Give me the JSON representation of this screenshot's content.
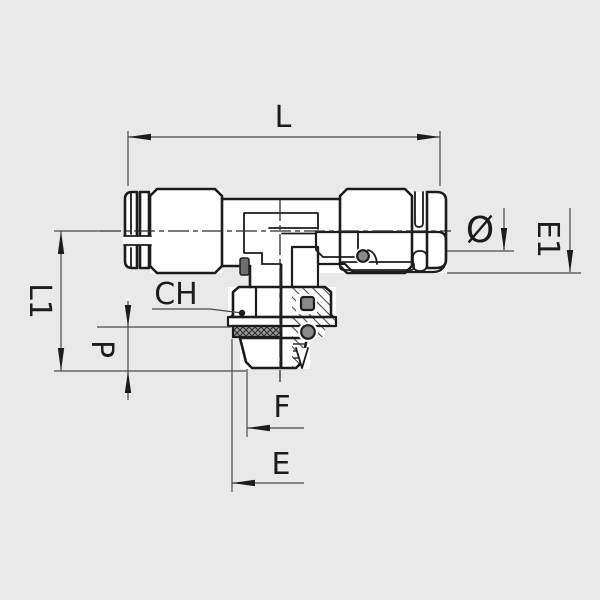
{
  "drawing": {
    "type": "technical-drawing",
    "subject": "push-in tee fitting half-section",
    "colors": {
      "background": "#e9e9e9",
      "line": "#1c1c1c",
      "dim_line": "#4a4a4a",
      "seal_gray": "#8a8a8a",
      "washer_dark": "#9b9b9b"
    },
    "labels": {
      "overall_length": "L",
      "height": "L1",
      "thread_length": "P",
      "hex": "CH",
      "diameter_symbol": "Ø",
      "cartridge_height": "E1",
      "thread_dim": "F",
      "hex_dim": "E"
    }
  }
}
